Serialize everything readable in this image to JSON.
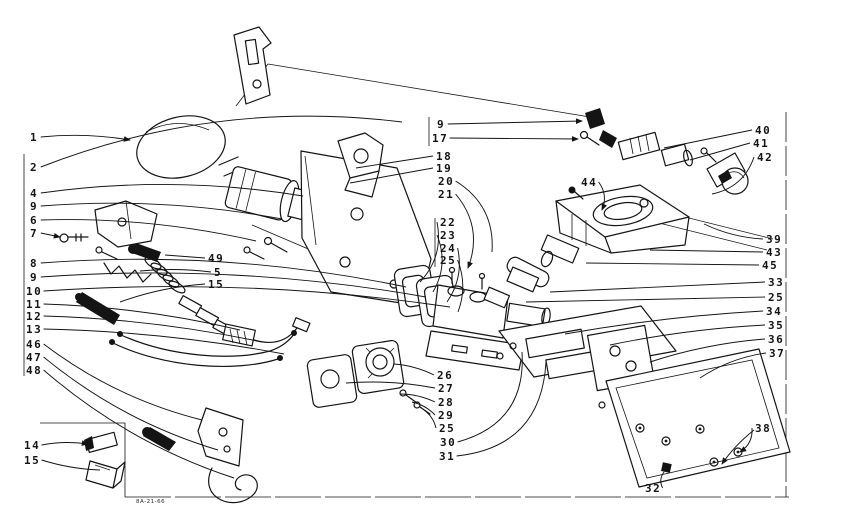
{
  "meta": {
    "description": "Exploded parts line diagram of a gas burner assembly with numbered callouts",
    "background": "#ffffff",
    "ink": "#141414",
    "drawing_code": "8A-21-66"
  },
  "diagram": {
    "type": "exploded-parts-diagram",
    "labels": [
      {
        "id": "1",
        "text": "1",
        "lx": 30,
        "ly": 141,
        "tx": 130,
        "ty": 140,
        "bend": -6,
        "arrow": true
      },
      {
        "id": "2",
        "text": "2",
        "lx": 30,
        "ly": 171,
        "tx": 402,
        "ty": 122,
        "bend": -46,
        "arrow": false
      },
      {
        "id": "4",
        "text": "4",
        "lx": 30,
        "ly": 197,
        "tx": 303,
        "ty": 196,
        "bend": -20,
        "arrow": false
      },
      {
        "id": "9a",
        "text": "9",
        "lx": 30,
        "ly": 210,
        "tx": 282,
        "ty": 219,
        "bend": -16,
        "arrow": false
      },
      {
        "id": "6",
        "text": "6",
        "lx": 30,
        "ly": 224,
        "tx": 256,
        "ty": 241,
        "bend": -14,
        "arrow": false
      },
      {
        "id": "7",
        "text": "7",
        "lx": 30,
        "ly": 237,
        "tx": 60,
        "ty": 237,
        "bend": 0,
        "arrow": true
      },
      {
        "id": "8",
        "text": "8",
        "lx": 30,
        "ly": 267,
        "tx": 406,
        "ty": 287,
        "bend": -26,
        "arrow": false
      },
      {
        "id": "9b",
        "text": "9",
        "lx": 30,
        "ly": 281,
        "tx": 426,
        "ty": 297,
        "bend": -24,
        "arrow": false
      },
      {
        "id": "10",
        "text": "10",
        "lx": 26,
        "ly": 295,
        "tx": 450,
        "ty": 307,
        "bend": -22,
        "arrow": false
      },
      {
        "id": "11",
        "text": "11",
        "lx": 26,
        "ly": 308,
        "tx": 240,
        "ty": 330,
        "bend": -10,
        "arrow": false
      },
      {
        "id": "12",
        "text": "12",
        "lx": 26,
        "ly": 320,
        "tx": 262,
        "ty": 342,
        "bend": -10,
        "arrow": false
      },
      {
        "id": "13",
        "text": "13",
        "lx": 26,
        "ly": 333,
        "tx": 284,
        "ty": 354,
        "bend": -10,
        "arrow": false
      },
      {
        "id": "46",
        "text": "46",
        "lx": 26,
        "ly": 348,
        "tx": 202,
        "ty": 420,
        "bend": 18,
        "arrow": false
      },
      {
        "id": "47",
        "text": "47",
        "lx": 26,
        "ly": 361,
        "tx": 218,
        "ty": 450,
        "bend": 20,
        "arrow": false
      },
      {
        "id": "48",
        "text": "48",
        "lx": 26,
        "ly": 374,
        "tx": 234,
        "ty": 478,
        "bend": 22,
        "arrow": false
      },
      {
        "id": "14",
        "text": "14",
        "lx": 24,
        "ly": 449,
        "tx": 88,
        "ty": 444,
        "bend": -4,
        "arrow": true
      },
      {
        "id": "15b",
        "text": "15",
        "lx": 24,
        "ly": 464,
        "tx": 100,
        "ty": 470,
        "bend": 4,
        "arrow": false
      },
      {
        "id": "49",
        "text": "49",
        "lx": 208,
        "ly": 262,
        "tx": 165,
        "ty": 255,
        "bend": 0,
        "arrow": false
      },
      {
        "id": "5m",
        "text": "5",
        "lx": 214,
        "ly": 276,
        "tx": 140,
        "ty": 271,
        "bend": 4,
        "arrow": false
      },
      {
        "id": "15m",
        "text": "15",
        "lx": 208,
        "ly": 288,
        "tx": 120,
        "ty": 302,
        "bend": 6,
        "arrow": false
      },
      {
        "id": "9t",
        "text": "9",
        "lx": 437,
        "ly": 128,
        "tx": 582,
        "ty": 121,
        "bend": 0,
        "arrow": true
      },
      {
        "id": "17",
        "text": "17",
        "lx": 432,
        "ly": 142,
        "tx": 578,
        "ty": 139,
        "bend": 0,
        "arrow": true
      },
      {
        "id": "18",
        "text": "18",
        "lx": 436,
        "ly": 160,
        "tx": 356,
        "ty": 168,
        "bend": 0,
        "arrow": false
      },
      {
        "id": "19",
        "text": "19",
        "lx": 436,
        "ly": 172,
        "tx": 350,
        "ty": 183,
        "bend": 0,
        "arrow": false
      },
      {
        "id": "20",
        "text": "20",
        "lx": 438,
        "ly": 185,
        "tx": 492,
        "ty": 252,
        "bend": -24,
        "arrow": false
      },
      {
        "id": "21",
        "text": "21",
        "lx": 438,
        "ly": 198,
        "tx": 468,
        "ty": 268,
        "bend": -22,
        "arrow": true
      },
      {
        "id": "22",
        "text": "22",
        "lx": 440,
        "ly": 226,
        "tx": 420,
        "ty": 282,
        "bend": -16,
        "arrow": false
      },
      {
        "id": "23",
        "text": "23",
        "lx": 440,
        "ly": 239,
        "tx": 433,
        "ty": 292,
        "bend": -14,
        "arrow": false
      },
      {
        "id": "24",
        "text": "24",
        "lx": 440,
        "ly": 252,
        "tx": 447,
        "ty": 302,
        "bend": -12,
        "arrow": false
      },
      {
        "id": "25m",
        "text": "25",
        "lx": 440,
        "ly": 264,
        "tx": 458,
        "ty": 312,
        "bend": -10,
        "arrow": false
      },
      {
        "id": "26",
        "text": "26",
        "lx": 437,
        "ly": 379,
        "tx": 394,
        "ty": 364,
        "bend": 4,
        "arrow": false
      },
      {
        "id": "27",
        "text": "27",
        "lx": 438,
        "ly": 392,
        "tx": 346,
        "ty": 383,
        "bend": 6,
        "arrow": false
      },
      {
        "id": "28",
        "text": "28",
        "lx": 438,
        "ly": 406,
        "tx": 400,
        "ty": 394,
        "bend": 4,
        "arrow": false
      },
      {
        "id": "29",
        "text": "29",
        "lx": 438,
        "ly": 419,
        "tx": 412,
        "ty": 402,
        "bend": 4,
        "arrow": false
      },
      {
        "id": "25b",
        "text": "25",
        "lx": 439,
        "ly": 432,
        "tx": 424,
        "ty": 410,
        "bend": 4,
        "arrow": false
      },
      {
        "id": "30",
        "text": "30",
        "lx": 440,
        "ly": 446,
        "tx": 522,
        "ty": 352,
        "bend": 45,
        "arrow": false
      },
      {
        "id": "31",
        "text": "31",
        "lx": 439,
        "ly": 460,
        "tx": 546,
        "ty": 362,
        "bend": 55,
        "arrow": false
      },
      {
        "id": "40",
        "text": "40",
        "lx": 755,
        "ly": 134,
        "tx": 664,
        "ty": 148,
        "bend": 0,
        "arrow": false
      },
      {
        "id": "41",
        "text": "41",
        "lx": 753,
        "ly": 147,
        "tx": 690,
        "ty": 160,
        "bend": 0,
        "arrow": false
      },
      {
        "id": "42",
        "text": "42",
        "lx": 757,
        "ly": 161,
        "tx": 712,
        "ty": 194,
        "bend": -16,
        "arrow": false
      },
      {
        "id": "39",
        "text": "39",
        "lx": 766,
        "ly": 243,
        "tx": 704,
        "ty": 224,
        "bend": -6,
        "arrow": false
      },
      {
        "id": "43",
        "text": "43",
        "lx": 766,
        "ly": 256,
        "tx": 650,
        "ty": 250,
        "bend": 0,
        "arrow": false
      },
      {
        "id": "45",
        "text": "45",
        "lx": 762,
        "ly": 269,
        "tx": 586,
        "ty": 263,
        "bend": 0,
        "arrow": false
      },
      {
        "id": "33",
        "text": "33",
        "lx": 768,
        "ly": 286,
        "tx": 550,
        "ty": 292,
        "bend": 0,
        "arrow": false
      },
      {
        "id": "25r",
        "text": "25",
        "lx": 768,
        "ly": 301,
        "tx": 526,
        "ty": 302,
        "bend": 0,
        "arrow": false
      },
      {
        "id": "34",
        "text": "34",
        "lx": 766,
        "ly": 315,
        "tx": 565,
        "ty": 334,
        "bend": 6,
        "arrow": false
      },
      {
        "id": "35",
        "text": "35",
        "lx": 768,
        "ly": 329,
        "tx": 610,
        "ty": 345,
        "bend": 6,
        "arrow": false
      },
      {
        "id": "36",
        "text": "36",
        "lx": 768,
        "ly": 343,
        "tx": 650,
        "ty": 362,
        "bend": 7,
        "arrow": false
      },
      {
        "id": "37",
        "text": "37",
        "lx": 769,
        "ly": 357,
        "tx": 700,
        "ty": 378,
        "bend": 8,
        "arrow": false
      },
      {
        "id": "38",
        "text": "38",
        "lx": 755,
        "ly": 432,
        "tx": 740,
        "ty": 452,
        "bend": -8,
        "arrow": true
      },
      {
        "id": "32",
        "text": "32",
        "lx": 645,
        "ly": 492,
        "tx": 664,
        "ty": 472,
        "bend": -5,
        "arrow": false
      },
      {
        "id": "44",
        "text": "44",
        "lx": 581,
        "ly": 186,
        "tx": 602,
        "ty": 210,
        "bend": -8,
        "arrow": true
      }
    ]
  }
}
